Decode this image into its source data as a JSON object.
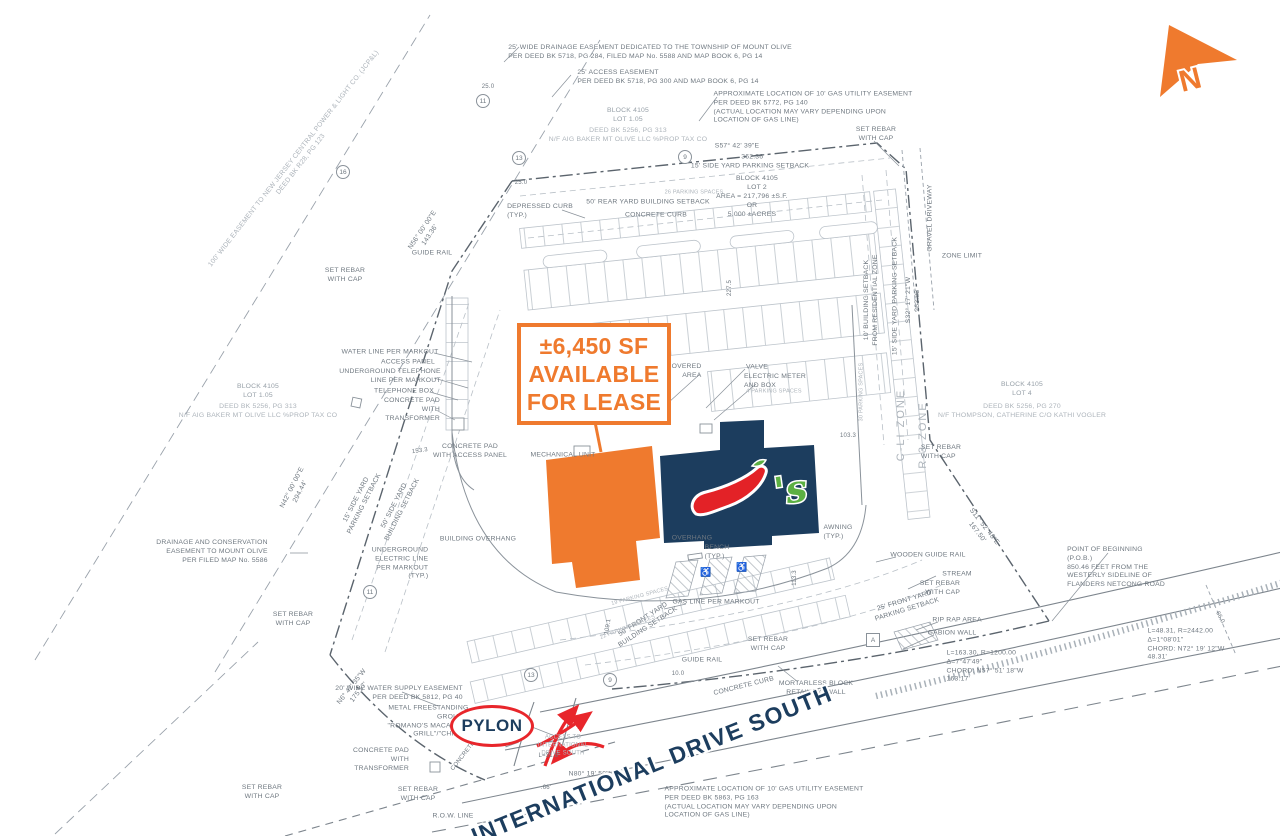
{
  "colors": {
    "orange": "#EF7A2E",
    "navy": "#1C3D5E",
    "red": "#E8262B",
    "green": "#5CB043",
    "text": "#6f7880",
    "gray2": "#97a0a8",
    "gray3": "#adb4bb",
    "line": "#8a929a"
  },
  "north_arrow": {
    "label": "N"
  },
  "callout": {
    "lines": [
      "±6,450 SF",
      "AVAILABLE",
      "FOR LEASE"
    ]
  },
  "street": {
    "name": "INTERNATIONAL DRIVE SOUTH"
  },
  "pylon": {
    "label": "PYLON"
  },
  "chilis": {
    "wordmark": "'s"
  },
  "plan": {
    "labels": [
      {
        "t": "25' WIDE DRAINAGE EASEMENT DEDICATED TO THE TOWNSHIP OF MOUNT OLIVE\nPER DEED BK 5718, PG 284, FILED MAP No. 5588 AND MAP BOOK 6, PG 14",
        "x": 650,
        "y": 53,
        "a": "left"
      },
      {
        "t": "25' ACCESS EASEMENT\nPER DEED BK 5718, PG 300 AND MAP BOOK 6, PG 14",
        "x": 668,
        "y": 78,
        "a": "left"
      },
      {
        "t": "APPROXIMATE LOCATION OF 10' GAS UTILITY EASEMENT\nPER DEED BK 5772, PG 140\n(ACTUAL LOCATION MAY VARY DEPENDING UPON\nLOCATION OF GAS LINE)",
        "x": 813,
        "y": 108,
        "a": "left"
      },
      {
        "t": "BLOCK 4105\nLOT 1.05",
        "x": 628,
        "y": 116,
        "c": "gray2"
      },
      {
        "t": "DEED BK 5256, PG 313\nN/F AIG BAKER MT OLIVE LLC %PROP TAX CO",
        "x": 628,
        "y": 136,
        "c": "gray3"
      },
      {
        "t": "SET REBAR\nWITH CAP",
        "x": 876,
        "y": 135
      },
      {
        "t": "S57° 42' 39\"E",
        "x": 737,
        "y": 147
      },
      {
        "t": "362.36'",
        "x": 753,
        "y": 158
      },
      {
        "t": "15' SIDE YARD PARKING SETBACK",
        "x": 750,
        "y": 167
      },
      {
        "t": "BLOCK 4105\nLOT 2",
        "x": 757,
        "y": 184
      },
      {
        "t": "AREA = 217,796 ±S.F.\nOR\n5.000 ±ACRES",
        "x": 752,
        "y": 206
      },
      {
        "t": "DEPRESSED CURB\n(TYP.)",
        "x": 540,
        "y": 212,
        "a": "left"
      },
      {
        "t": "50' REAR YARD BUILDING SETBACK",
        "x": 648,
        "y": 203
      },
      {
        "t": "CONCRETE CURB",
        "x": 656,
        "y": 216
      },
      {
        "t": "26 PARKING SPACES",
        "x": 694,
        "y": 193,
        "c": "gray3",
        "s": 5.5
      },
      {
        "t": "100' WIDE EASEMENT TO NEW JERSEY CENTRAL POWER & LIGHT CO. (JCP&L)\nDEED BK R28, PG 123",
        "x": 298,
        "y": 162,
        "r": -52,
        "c": "gray3"
      },
      {
        "t": "N56° 00' 00\"E\n143.36'",
        "x": 427,
        "y": 233,
        "r": -56
      },
      {
        "t": "SET REBAR\nWITH CAP",
        "x": 345,
        "y": 276
      },
      {
        "t": "GUIDE RAIL",
        "x": 432,
        "y": 254
      },
      {
        "t": "25.0",
        "x": 488,
        "y": 88,
        "s": 6
      },
      {
        "t": "25.0",
        "x": 521,
        "y": 184,
        "s": 6
      },
      {
        "t": "GRAVEL DRIVEWAY",
        "x": 931,
        "y": 218,
        "r": -90
      },
      {
        "t": "ZONE LIMIT",
        "x": 962,
        "y": 257,
        "a": "left"
      },
      {
        "t": "15' SIDE YARD PARKING SETBACK",
        "x": 896,
        "y": 296,
        "r": -90
      },
      {
        "t": "S32° 17' 21\"W\n263.83'",
        "x": 914,
        "y": 300,
        "r": -90
      },
      {
        "t": "10' BUILDING SETBACK\nFROM RESIDENTIAL ZONE",
        "x": 872,
        "y": 300,
        "r": -90
      },
      {
        "t": "227.5",
        "x": 731,
        "y": 288,
        "r": -90,
        "s": 6
      },
      {
        "t": "WATER LINE PER MARKOUT",
        "x": 390,
        "y": 353,
        "a": "right"
      },
      {
        "t": "ACCESS PANEL",
        "x": 408,
        "y": 363,
        "a": "right"
      },
      {
        "t": "UNDERGROUND TELEPHONE\nLINE PER MARKOUT",
        "x": 390,
        "y": 377,
        "a": "right"
      },
      {
        "t": "TELEPHONE BOX",
        "x": 404,
        "y": 392,
        "a": "right"
      },
      {
        "t": "CONCRETE PAD\nWITH\nTRANSFORMER",
        "x": 412,
        "y": 410,
        "a": "right"
      },
      {
        "t": "BLOCK 4105\nLOT 1.05",
        "x": 258,
        "y": 392,
        "c": "gray2"
      },
      {
        "t": "DEED BK 5256, PG 313\nN/F AIG BAKER MT OLIVE LLC %PROP TAX CO",
        "x": 258,
        "y": 412,
        "c": "gray3"
      },
      {
        "t": "N42° 00' 00\"E\n294.44'",
        "x": 297,
        "y": 490,
        "r": -63
      },
      {
        "t": "15' SIDE YARD\nPARKING SETBACK",
        "x": 361,
        "y": 502,
        "r": -63
      },
      {
        "t": "50' SIDE YARD\nBUILDING SETBACK",
        "x": 399,
        "y": 508,
        "r": -63
      },
      {
        "t": "153.3",
        "x": 420,
        "y": 452,
        "r": -8,
        "s": 6
      },
      {
        "t": "CONCRETE PAD\nWITH ACCESS PANEL",
        "x": 470,
        "y": 452
      },
      {
        "t": "MECHANICAL UNIT",
        "x": 563,
        "y": 456
      },
      {
        "t": "COVERED\nAREA",
        "x": 684,
        "y": 372,
        "a": "right"
      },
      {
        "t": "VALVE",
        "x": 757,
        "y": 368,
        "a": "left"
      },
      {
        "t": "ELECTRIC METER\nAND BOX",
        "x": 775,
        "y": 382,
        "a": "left"
      },
      {
        "t": "4 PARKING SPACES",
        "x": 774,
        "y": 392,
        "s": 5.5,
        "c": "gray3"
      },
      {
        "t": "30 PARKING SPACES",
        "x": 862,
        "y": 392,
        "r": -90,
        "s": 5.5,
        "c": "gray3"
      },
      {
        "t": "103.3",
        "x": 848,
        "y": 437,
        "s": 6
      },
      {
        "t": "UNDERGROUND\nELECTRIC LINE\nPER MARKOUT\n(TYP.)",
        "x": 400,
        "y": 564,
        "a": "right"
      },
      {
        "t": "BUILDING OVERHANG",
        "x": 478,
        "y": 540
      },
      {
        "t": "DRAINAGE AND CONSERVATION\nEASEMENT TO MOUNT OLIVE\nPER FILED MAP No. 5586",
        "x": 212,
        "y": 552,
        "a": "right"
      },
      {
        "t": "SET REBAR\nWITH CAP",
        "x": 293,
        "y": 620
      },
      {
        "t": "OVERHANG",
        "x": 692,
        "y": 539
      },
      {
        "t": "BENCH\n(TYP.)",
        "x": 717,
        "y": 553,
        "a": "left"
      },
      {
        "t": "AWNING\n(TYP.)",
        "x": 838,
        "y": 533,
        "a": "left"
      },
      {
        "t": "113.3",
        "x": 796,
        "y": 578,
        "r": -90,
        "s": 6
      },
      {
        "t": "WOODEN GUIDE RAIL",
        "x": 928,
        "y": 556,
        "a": "left"
      },
      {
        "t": "STREAM",
        "x": 957,
        "y": 575,
        "a": "right"
      },
      {
        "t": "SET REBAR\nWITH CAP",
        "x": 940,
        "y": 589,
        "a": "right"
      },
      {
        "t": "S11° 52' 48\"E\n167.50'",
        "x": 980,
        "y": 530,
        "r": 52
      },
      {
        "t": "SET REBAR\nWITH CAP",
        "x": 941,
        "y": 453,
        "a": "left"
      },
      {
        "t": "BLOCK 4105\nLOT 4",
        "x": 1022,
        "y": 390,
        "c": "gray2"
      },
      {
        "t": "DEED BK 5256, PG 270\nN/F THOMPSON, CATHERINE C/O KATHI VOGLER",
        "x": 1022,
        "y": 412,
        "c": "gray3"
      },
      {
        "t": "C-LI ZONE",
        "x": 901,
        "y": 425,
        "r": -90,
        "s": 11,
        "c": "gray3",
        "ls": 2
      },
      {
        "t": "R-3 ZONE",
        "x": 923,
        "y": 435,
        "r": -90,
        "s": 11,
        "c": "gray3",
        "ls": 2
      },
      {
        "t": "POINT OF BEGINNING\n(P.O.B.)\n850.46 FEET FROM THE\nWESTERLY SIDELINE OF\nFLANDERS NETCONG ROAD",
        "x": 1116,
        "y": 568,
        "a": "left"
      },
      {
        "t": "L=48.31, R=2442.00\nΔ=1°08'01\"\nCHORD: N72° 19' 12\"W\n48.31'",
        "x": 1186,
        "y": 645,
        "a": "left"
      },
      {
        "t": "L=163.30, R=1200.00\nΔ=7°47'49\"\nCHORD: N57° 51' 18\"W\n163.17'",
        "x": 985,
        "y": 667,
        "a": "left"
      },
      {
        "t": "66.0",
        "x": 1219,
        "y": 618,
        "r": 62,
        "s": 6
      },
      {
        "t": "RIP RAP AREA",
        "x": 957,
        "y": 621,
        "a": "left"
      },
      {
        "t": "GABION WALL",
        "x": 952,
        "y": 634,
        "a": "left"
      },
      {
        "t": "25' FRONT YARD\nPARKING SETBACK",
        "x": 906,
        "y": 606,
        "r": -17
      },
      {
        "t": "MORTARLESS BLOCK\nRETAINING WALL",
        "x": 816,
        "y": 689
      },
      {
        "t": "SET REBAR\nWITH CAP",
        "x": 768,
        "y": 645
      },
      {
        "t": "GUIDE RAIL",
        "x": 702,
        "y": 661,
        "a": "left"
      },
      {
        "t": "CONCRETE CURB",
        "x": 744,
        "y": 687,
        "r": -14
      },
      {
        "t": "10.0",
        "x": 678,
        "y": 675,
        "s": 6
      },
      {
        "t": "GAS LINE PER MARKOUT",
        "x": 716,
        "y": 603,
        "a": "left"
      },
      {
        "t": "50' FRONT YARD\nBUILDING SETBACK",
        "x": 646,
        "y": 624,
        "r": -33
      },
      {
        "t": "109.1",
        "x": 609,
        "y": 627,
        "r": -80,
        "s": 6
      },
      {
        "t": "19 PARKING SPACES",
        "x": 640,
        "y": 597,
        "r": -15,
        "s": 5.5,
        "c": "gray3"
      },
      {
        "t": "22 PARKING SPACES",
        "x": 628,
        "y": 628,
        "r": -21,
        "s": 5.5,
        "c": "gray3"
      },
      {
        "t": "SET REBAR\nWITH CAP",
        "x": 262,
        "y": 793
      },
      {
        "t": "20' WIDE WATER SUPPLY EASEMENT\nPER DEED BK 5812, PG 40",
        "x": 399,
        "y": 694,
        "a": "right"
      },
      {
        "t": "METAL FREESTANDING\nGROUND\n\"ROMANO'S MACARONI\nGRILL\"/\"CHILI'S\"",
        "x": 428,
        "y": 722,
        "a": "right"
      },
      {
        "t": "N6° 42' 35\"W\n175.57'",
        "x": 356,
        "y": 690,
        "r": -52
      },
      {
        "t": "CONCRETE PAD\nWITH\nTRANSFORMER",
        "x": 381,
        "y": 760,
        "a": "right"
      },
      {
        "t": "SET REBAR\nWITH CAP",
        "x": 418,
        "y": 795
      },
      {
        "t": "R.O.W. LINE",
        "x": 453,
        "y": 817,
        "a": "left"
      },
      {
        "t": "ACCESS TO\nINTERNATIONAL\nDRIVE SOUTH",
        "x": 563,
        "y": 746,
        "s": 6,
        "c": "gray3"
      },
      {
        "t": "L=31.8'",
        "x": 549,
        "y": 757,
        "s": 6
      },
      {
        "t": "N80° 19' 59\"W",
        "x": 592,
        "y": 775
      },
      {
        "t": ".66'",
        "x": 546,
        "y": 789,
        "s": 6
      },
      {
        "t": "APPROXIMATE LOCATION OF 10' GAS UTILITY EASEMENT\nPER DEED BK 5863, PG 163\n(ACTUAL LOCATION MAY VARY DEPENDING UPON\nLOCATION OF GAS LINE)",
        "x": 764,
        "y": 803,
        "a": "left"
      },
      {
        "t": "CONCRETE CURB",
        "x": 470,
        "y": 749,
        "r": -52,
        "s": 6
      },
      {
        "t": "♿",
        "x": 706,
        "y": 573,
        "s": 9,
        "c": "gray2"
      },
      {
        "t": "♿",
        "x": 742,
        "y": 568,
        "s": 9,
        "c": "gray2"
      }
    ],
    "markers": [
      {
        "shape": "circle",
        "label": "11",
        "x": 483,
        "y": 101
      },
      {
        "shape": "circle",
        "label": "13",
        "x": 519,
        "y": 158
      },
      {
        "shape": "circle",
        "label": "9",
        "x": 685,
        "y": 157
      },
      {
        "shape": "circle",
        "label": "16",
        "x": 343,
        "y": 172
      },
      {
        "shape": "circle",
        "label": "11",
        "x": 370,
        "y": 592
      },
      {
        "shape": "circle",
        "label": "13",
        "x": 531,
        "y": 675
      },
      {
        "shape": "circle",
        "label": "9",
        "x": 610,
        "y": 680
      },
      {
        "shape": "square",
        "label": "A",
        "x": 873,
        "y": 640
      }
    ]
  }
}
